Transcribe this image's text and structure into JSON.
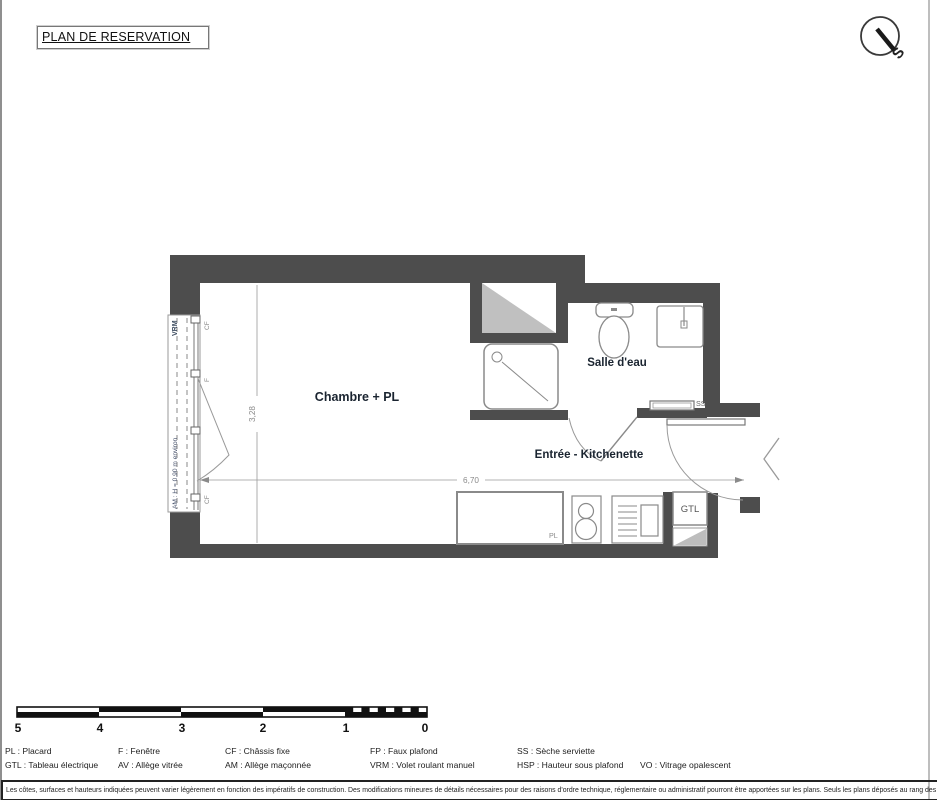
{
  "header": {
    "title": "PLAN DE RESERVATION"
  },
  "compass": {
    "south_label": "S"
  },
  "plan": {
    "room_labels": {
      "chambre": "Chambre + PL",
      "salle_eau": "Salle d'eau",
      "entree": "Entrée - Kitchenette"
    },
    "annotations": {
      "vrm": "VRM",
      "am": "AM : H = 0,90 m environ",
      "cf_top": "CF",
      "f": "F",
      "cf_bottom": "CF",
      "ss": "SS",
      "pl": "PL",
      "gtl": "GTL"
    },
    "dimensions": {
      "width_m": "6,70",
      "depth_m": "3,28"
    },
    "colors": {
      "wall": "#4d4d4d",
      "fixture_line": "#8a8a8a",
      "hatch": "#c0c0c0",
      "room_text": "#1a2430",
      "annotation_text": "#7a7a7a"
    }
  },
  "scalebar": {
    "ticks": [
      "5",
      "4",
      "3",
      "2",
      "1",
      "0"
    ]
  },
  "legend": {
    "items": [
      {
        "label": "PL : Placard"
      },
      {
        "label": "GTL : Tableau électrique"
      },
      {
        "label": "F : Fenêtre"
      },
      {
        "label": "AV : Allège vitrée"
      },
      {
        "label": "CF : Châssis fixe"
      },
      {
        "label": "AM : Allège maçonnée"
      },
      {
        "label": "FP : Faux plafond"
      },
      {
        "label": "VRM : Volet roulant manuel"
      },
      {
        "label": "SS : Sèche serviette"
      },
      {
        "label": "HSP : Hauteur sous plafond"
      },
      {
        "label": "VO : Vitrage opalescent"
      }
    ]
  },
  "disclaimer": {
    "text": "Les côtes, surfaces et hauteurs indiquées peuvent varier légèrement en fonction des impératifs de construction. Des modifications mineures de détails nécessaires pour des raisons d'ordre technique, réglementaire ou administratif pourront être apportées sur les plans. Seuls les plans déposés au rang des minutes du notaire font foi."
  }
}
